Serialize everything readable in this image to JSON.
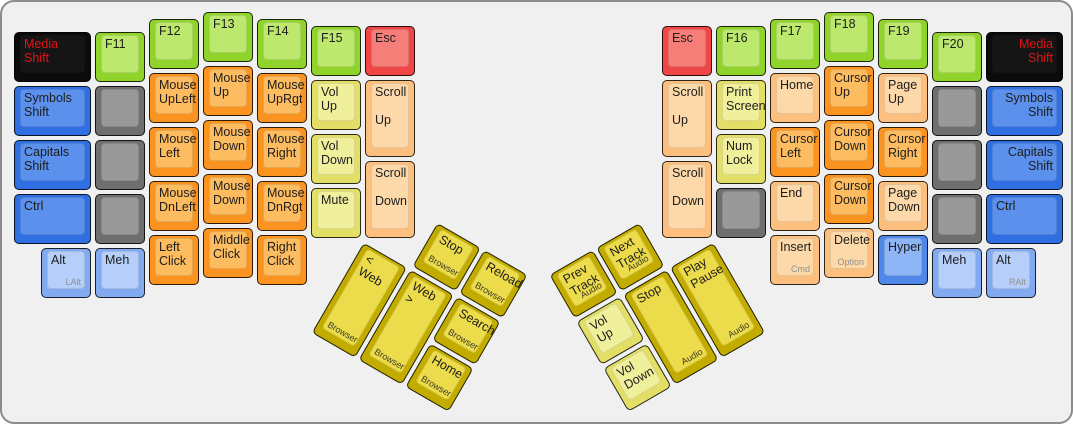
{
  "keyboard": {
    "description_title": "ErgoDox media-and-mouse layer keyboard layout",
    "background": "#f0f0f0",
    "border_color": "#8c8c8c",
    "unit_px": 54,
    "label_color": "#1d1d1d",
    "label_color_on_black": "#e01414",
    "sublabel_color": "#909090",
    "palette": {
      "green": {
        "side": "#90d32a",
        "top": "#bce96d"
      },
      "orange": {
        "side": "#fb9320",
        "top": "#fdbc60"
      },
      "peach": {
        "side": "#fcbf7e",
        "top": "#fdd9a9"
      },
      "yellow": {
        "side": "#e2de66",
        "top": "#f0ef9c"
      },
      "gold": {
        "side": "#c3ac00",
        "top": "#ecdb4a"
      },
      "blue": {
        "side": "#2f6fe2",
        "top": "#5b90ec"
      },
      "blue_hyper": {
        "side": "#4f88e9",
        "top": "#8eb5f6"
      },
      "blue_light": {
        "side": "#81aaf0",
        "top": "#b5cffa"
      },
      "gray": {
        "side": "#6f6f6f",
        "top": "#999999"
      },
      "black": {
        "side": "#0b0b0b",
        "top": "#151515"
      },
      "red": {
        "side": "#f04646",
        "top": "#f57e78"
      }
    },
    "clusters": [
      {
        "name": "left-main-cluster",
        "origin_px": [
          10,
          8
        ],
        "rotation_deg": 0,
        "keys": [
          {
            "name": "key-media-shift-left",
            "x": 0,
            "y": 0.375,
            "w": 1.5,
            "h": 1,
            "color": "black",
            "label": "Media\nShift"
          },
          {
            "name": "key-f11",
            "x": 1.5,
            "y": 0.375,
            "w": 1,
            "h": 1,
            "color": "green",
            "label": "F11"
          },
          {
            "name": "key-f12",
            "x": 2.5,
            "y": 0.125,
            "w": 1,
            "h": 1,
            "color": "green",
            "label": "F12"
          },
          {
            "name": "key-f13",
            "x": 3.5,
            "y": 0,
            "w": 1,
            "h": 1,
            "color": "green",
            "label": "F13"
          },
          {
            "name": "key-f14",
            "x": 4.5,
            "y": 0.125,
            "w": 1,
            "h": 1,
            "color": "green",
            "label": "F14"
          },
          {
            "name": "key-f15",
            "x": 5.5,
            "y": 0.25,
            "w": 1,
            "h": 1,
            "color": "green",
            "label": "F15"
          },
          {
            "name": "key-esc-left",
            "x": 6.5,
            "y": 0.25,
            "w": 1,
            "h": 1,
            "color": "red",
            "label": "Esc"
          },
          {
            "name": "key-symbols-shift-left",
            "x": 0,
            "y": 1.375,
            "w": 1.5,
            "h": 1,
            "color": "blue",
            "label": "Symbols\nShift"
          },
          {
            "name": "key-blank",
            "x": 1.5,
            "y": 1.375,
            "w": 1,
            "h": 1,
            "color": "gray",
            "label": ""
          },
          {
            "name": "key-mouse-upleft",
            "x": 2.5,
            "y": 1.125,
            "w": 1,
            "h": 1,
            "color": "orange",
            "label": "Mouse\nUpLeft"
          },
          {
            "name": "key-mouse-up",
            "x": 3.5,
            "y": 1,
            "w": 1,
            "h": 1,
            "color": "orange",
            "label": "Mouse\nUp"
          },
          {
            "name": "key-mouse-uprgt",
            "x": 4.5,
            "y": 1.125,
            "w": 1,
            "h": 1,
            "color": "orange",
            "label": "Mouse\nUpRgt"
          },
          {
            "name": "key-vol-up-left",
            "x": 5.5,
            "y": 1.25,
            "w": 1,
            "h": 1,
            "color": "yellow",
            "label": "Vol\nUp"
          },
          {
            "name": "key-scroll-up-left",
            "x": 6.5,
            "y": 1.25,
            "w": 1,
            "h": 1.5,
            "color": "peach",
            "label": "Scroll\n\nUp"
          },
          {
            "name": "key-capitals-shift-left",
            "x": 0,
            "y": 2.375,
            "w": 1.5,
            "h": 1,
            "color": "blue",
            "label": "Capitals\nShift"
          },
          {
            "name": "key-blank",
            "x": 1.5,
            "y": 2.375,
            "w": 1,
            "h": 1,
            "color": "gray",
            "label": ""
          },
          {
            "name": "key-mouse-left",
            "x": 2.5,
            "y": 2.125,
            "w": 1,
            "h": 1,
            "color": "orange",
            "label": "Mouse\nLeft"
          },
          {
            "name": "key-mouse-down",
            "x": 3.5,
            "y": 2,
            "w": 1,
            "h": 1,
            "color": "orange",
            "label": "Mouse\nDown"
          },
          {
            "name": "key-mouse-right",
            "x": 4.5,
            "y": 2.125,
            "w": 1,
            "h": 1,
            "color": "orange",
            "label": "Mouse\nRight"
          },
          {
            "name": "key-vol-down-left",
            "x": 5.5,
            "y": 2.25,
            "w": 1,
            "h": 1,
            "color": "yellow",
            "label": "Vol\nDown"
          },
          {
            "name": "key-scroll-down-left",
            "x": 6.5,
            "y": 2.75,
            "w": 1,
            "h": 1.5,
            "color": "peach",
            "label": "Scroll\n\nDown"
          },
          {
            "name": "key-ctrl-left",
            "x": 0,
            "y": 3.375,
            "w": 1.5,
            "h": 1,
            "color": "blue",
            "label": "Ctrl"
          },
          {
            "name": "key-blank",
            "x": 1.5,
            "y": 3.375,
            "w": 1,
            "h": 1,
            "color": "gray",
            "label": ""
          },
          {
            "name": "key-mouse-dnleft",
            "x": 2.5,
            "y": 3.125,
            "w": 1,
            "h": 1,
            "color": "orange",
            "label": "Mouse\nDnLeft"
          },
          {
            "name": "key-mouse-down-2",
            "x": 3.5,
            "y": 3,
            "w": 1,
            "h": 1,
            "color": "orange",
            "label": "Mouse\nDown"
          },
          {
            "name": "key-mouse-dnrgt",
            "x": 4.5,
            "y": 3.125,
            "w": 1,
            "h": 1,
            "color": "orange",
            "label": "Mouse\nDnRgt"
          },
          {
            "name": "key-mute",
            "x": 5.5,
            "y": 3.25,
            "w": 1,
            "h": 1,
            "color": "yellow",
            "label": "Mute"
          },
          {
            "name": "key-alt-left",
            "x": 0.5,
            "y": 4.375,
            "w": 1,
            "h": 1,
            "color": "blue_light",
            "label": "Alt",
            "sub": "LAlt",
            "sub_pos": "br"
          },
          {
            "name": "key-meh-left",
            "x": 1.5,
            "y": 4.375,
            "w": 1,
            "h": 1,
            "color": "blue_light",
            "label": "Meh"
          },
          {
            "name": "key-left-click",
            "x": 2.5,
            "y": 4.125,
            "w": 1,
            "h": 1,
            "color": "orange",
            "label": "Left\nClick"
          },
          {
            "name": "key-middle-click",
            "x": 3.5,
            "y": 4,
            "w": 1,
            "h": 1,
            "color": "orange",
            "label": "Middle\nClick"
          },
          {
            "name": "key-right-click",
            "x": 4.5,
            "y": 4.125,
            "w": 1,
            "h": 1,
            "color": "orange",
            "label": "Right\nClick"
          }
        ]
      },
      {
        "name": "left-thumb-cluster",
        "origin_px": [
          361,
          237.5
        ],
        "rotation_deg": 30,
        "sub_color": "#3d3d28",
        "keys": [
          {
            "name": "key-browser-stop",
            "x": 1,
            "y": -1,
            "w": 1,
            "h": 1,
            "color": "gold",
            "label": "Stop",
            "sub": "Browser",
            "sub_pos": "bl"
          },
          {
            "name": "key-browser-reload",
            "x": 2,
            "y": -1,
            "w": 1,
            "h": 1,
            "color": "gold",
            "label": "Reload",
            "sub": "Browser",
            "sub_pos": "bl"
          },
          {
            "name": "key-browser-back",
            "x": 0,
            "y": 0,
            "w": 1,
            "h": 2,
            "color": "gold",
            "label": "< Web",
            "sub": "Browser",
            "sub_pos": "bl"
          },
          {
            "name": "key-browser-forward",
            "x": 1,
            "y": 0,
            "w": 1,
            "h": 2,
            "color": "gold",
            "label": "Web >",
            "sub": "Browser",
            "sub_pos": "bl"
          },
          {
            "name": "key-browser-search",
            "x": 2,
            "y": 0,
            "w": 1,
            "h": 1,
            "color": "gold",
            "label": "Search",
            "sub": "Browser",
            "sub_pos": "bl"
          },
          {
            "name": "key-browser-home",
            "x": 2,
            "y": 1,
            "w": 1,
            "h": 1,
            "color": "gold",
            "label": "Home",
            "sub": "Browser",
            "sub_pos": "bl"
          }
        ]
      },
      {
        "name": "right-main-cluster",
        "origin_px": [
          658,
          8
        ],
        "rotation_deg": 0,
        "keys": [
          {
            "name": "key-esc-right",
            "x": 0,
            "y": 0.25,
            "w": 1,
            "h": 1,
            "color": "red",
            "label": "Esc"
          },
          {
            "name": "key-f16",
            "x": 1,
            "y": 0.25,
            "w": 1,
            "h": 1,
            "color": "green",
            "label": "F16"
          },
          {
            "name": "key-f17",
            "x": 2,
            "y": 0.125,
            "w": 1,
            "h": 1,
            "color": "green",
            "label": "F17"
          },
          {
            "name": "key-f18",
            "x": 3,
            "y": 0,
            "w": 1,
            "h": 1,
            "color": "green",
            "label": "F18"
          },
          {
            "name": "key-f19",
            "x": 4,
            "y": 0.125,
            "w": 1,
            "h": 1,
            "color": "green",
            "label": "F19"
          },
          {
            "name": "key-f20",
            "x": 5,
            "y": 0.375,
            "w": 1,
            "h": 1,
            "color": "green",
            "label": "F20"
          },
          {
            "name": "key-media-shift-right",
            "x": 6,
            "y": 0.375,
            "w": 1.5,
            "h": 1,
            "color": "black",
            "label": "Media\nShift",
            "align": "right"
          },
          {
            "name": "key-scroll-up-right",
            "x": 0,
            "y": 1.25,
            "w": 1,
            "h": 1.5,
            "color": "peach",
            "label": "Scroll\n\nUp"
          },
          {
            "name": "key-print-screen",
            "x": 1,
            "y": 1.25,
            "w": 1,
            "h": 1,
            "color": "yellow",
            "label": "Print\nScreen"
          },
          {
            "name": "key-home",
            "x": 2,
            "y": 1.125,
            "w": 1,
            "h": 1,
            "color": "peach",
            "label": "Home"
          },
          {
            "name": "key-cursor-up",
            "x": 3,
            "y": 1,
            "w": 1,
            "h": 1,
            "color": "orange",
            "label": "Cursor\nUp"
          },
          {
            "name": "key-page-up",
            "x": 4,
            "y": 1.125,
            "w": 1,
            "h": 1,
            "color": "peach",
            "label": "Page\nUp"
          },
          {
            "name": "key-blank",
            "x": 5,
            "y": 1.375,
            "w": 1,
            "h": 1,
            "color": "gray",
            "label": ""
          },
          {
            "name": "key-symbols-shift-right",
            "x": 6,
            "y": 1.375,
            "w": 1.5,
            "h": 1,
            "color": "blue",
            "label": "Symbols\nShift",
            "align": "right"
          },
          {
            "name": "key-scroll-down-right",
            "x": 0,
            "y": 2.75,
            "w": 1,
            "h": 1.5,
            "color": "peach",
            "label": "Scroll\n\nDown"
          },
          {
            "name": "key-num-lock",
            "x": 1,
            "y": 2.25,
            "w": 1,
            "h": 1,
            "color": "yellow",
            "label": "Num\nLock"
          },
          {
            "name": "key-cursor-left",
            "x": 2,
            "y": 2.125,
            "w": 1,
            "h": 1,
            "color": "orange",
            "label": "Cursor\nLeft"
          },
          {
            "name": "key-cursor-down",
            "x": 3,
            "y": 2,
            "w": 1,
            "h": 1,
            "color": "orange",
            "label": "Cursor\nDown"
          },
          {
            "name": "key-cursor-right",
            "x": 4,
            "y": 2.125,
            "w": 1,
            "h": 1,
            "color": "orange",
            "label": "Cursor\nRight"
          },
          {
            "name": "key-blank",
            "x": 5,
            "y": 2.375,
            "w": 1,
            "h": 1,
            "color": "gray",
            "label": ""
          },
          {
            "name": "key-capitals-shift-right",
            "x": 6,
            "y": 2.375,
            "w": 1.5,
            "h": 1,
            "color": "blue",
            "label": "Capitals\nShift",
            "align": "right"
          },
          {
            "name": "key-blank",
            "x": 1,
            "y": 3.25,
            "w": 1,
            "h": 1,
            "color": "gray",
            "label": ""
          },
          {
            "name": "key-end",
            "x": 2,
            "y": 3.125,
            "w": 1,
            "h": 1,
            "color": "peach",
            "label": "End"
          },
          {
            "name": "key-cursor-down-2",
            "x": 3,
            "y": 3,
            "w": 1,
            "h": 1,
            "color": "orange",
            "label": "Cursor\nDown"
          },
          {
            "name": "key-page-down",
            "x": 4,
            "y": 3.125,
            "w": 1,
            "h": 1,
            "color": "peach",
            "label": "Page\nDown"
          },
          {
            "name": "key-blank",
            "x": 5,
            "y": 3.375,
            "w": 1,
            "h": 1,
            "color": "gray",
            "label": ""
          },
          {
            "name": "key-ctrl-right",
            "x": 6,
            "y": 3.375,
            "w": 1.5,
            "h": 1,
            "color": "blue",
            "label": "Ctrl"
          },
          {
            "name": "key-insert",
            "x": 2,
            "y": 4.125,
            "w": 1,
            "h": 1,
            "color": "peach",
            "label": "Insert",
            "sub": "Cmd",
            "sub_pos": "br"
          },
          {
            "name": "key-delete",
            "x": 3,
            "y": 4,
            "w": 1,
            "h": 1,
            "color": "peach",
            "label": "Delete",
            "sub": "Option",
            "sub_pos": "br"
          },
          {
            "name": "key-hyper",
            "x": 4,
            "y": 4.125,
            "w": 1,
            "h": 1,
            "color": "blue_hyper",
            "label": "Hyper"
          },
          {
            "name": "key-meh-right",
            "x": 5,
            "y": 4.375,
            "w": 1,
            "h": 1,
            "color": "blue_light",
            "label": "Meh"
          },
          {
            "name": "key-alt-right",
            "x": 6,
            "y": 4.375,
            "w": 1,
            "h": 1,
            "color": "blue_light",
            "label": "Alt",
            "sub": "RAlt",
            "sub_pos": "br"
          }
        ]
      },
      {
        "name": "right-thumb-cluster",
        "origin_px": [
          712,
          237.5
        ],
        "rotation_deg": -30,
        "sub_color": "#3d3d28",
        "keys": [
          {
            "name": "key-audio-prev",
            "x": -3,
            "y": -1,
            "w": 1,
            "h": 1,
            "color": "gold",
            "label": "Prev\nTrack",
            "sub": "Audio",
            "sub_pos": "br"
          },
          {
            "name": "key-audio-next",
            "x": -2,
            "y": -1,
            "w": 1,
            "h": 1,
            "color": "gold",
            "label": "Next\nTrack",
            "sub": "Audio",
            "sub_pos": "br"
          },
          {
            "name": "key-vol-up-thumb",
            "x": -3,
            "y": 0,
            "w": 1,
            "h": 1,
            "color": "yellow",
            "label": "Vol\nUp"
          },
          {
            "name": "key-audio-stop",
            "x": -2,
            "y": 0,
            "w": 1,
            "h": 2,
            "color": "gold",
            "label": "Stop",
            "sub": "Audio",
            "sub_pos": "br"
          },
          {
            "name": "key-audio-play",
            "x": -1,
            "y": 0,
            "w": 1,
            "h": 2,
            "color": "gold",
            "label": "Play\nPause",
            "sub": "Audio",
            "sub_pos": "br"
          },
          {
            "name": "key-vol-down-thumb",
            "x": -3,
            "y": 1,
            "w": 1,
            "h": 1,
            "color": "yellow",
            "label": "Vol\nDown"
          }
        ]
      }
    ]
  }
}
